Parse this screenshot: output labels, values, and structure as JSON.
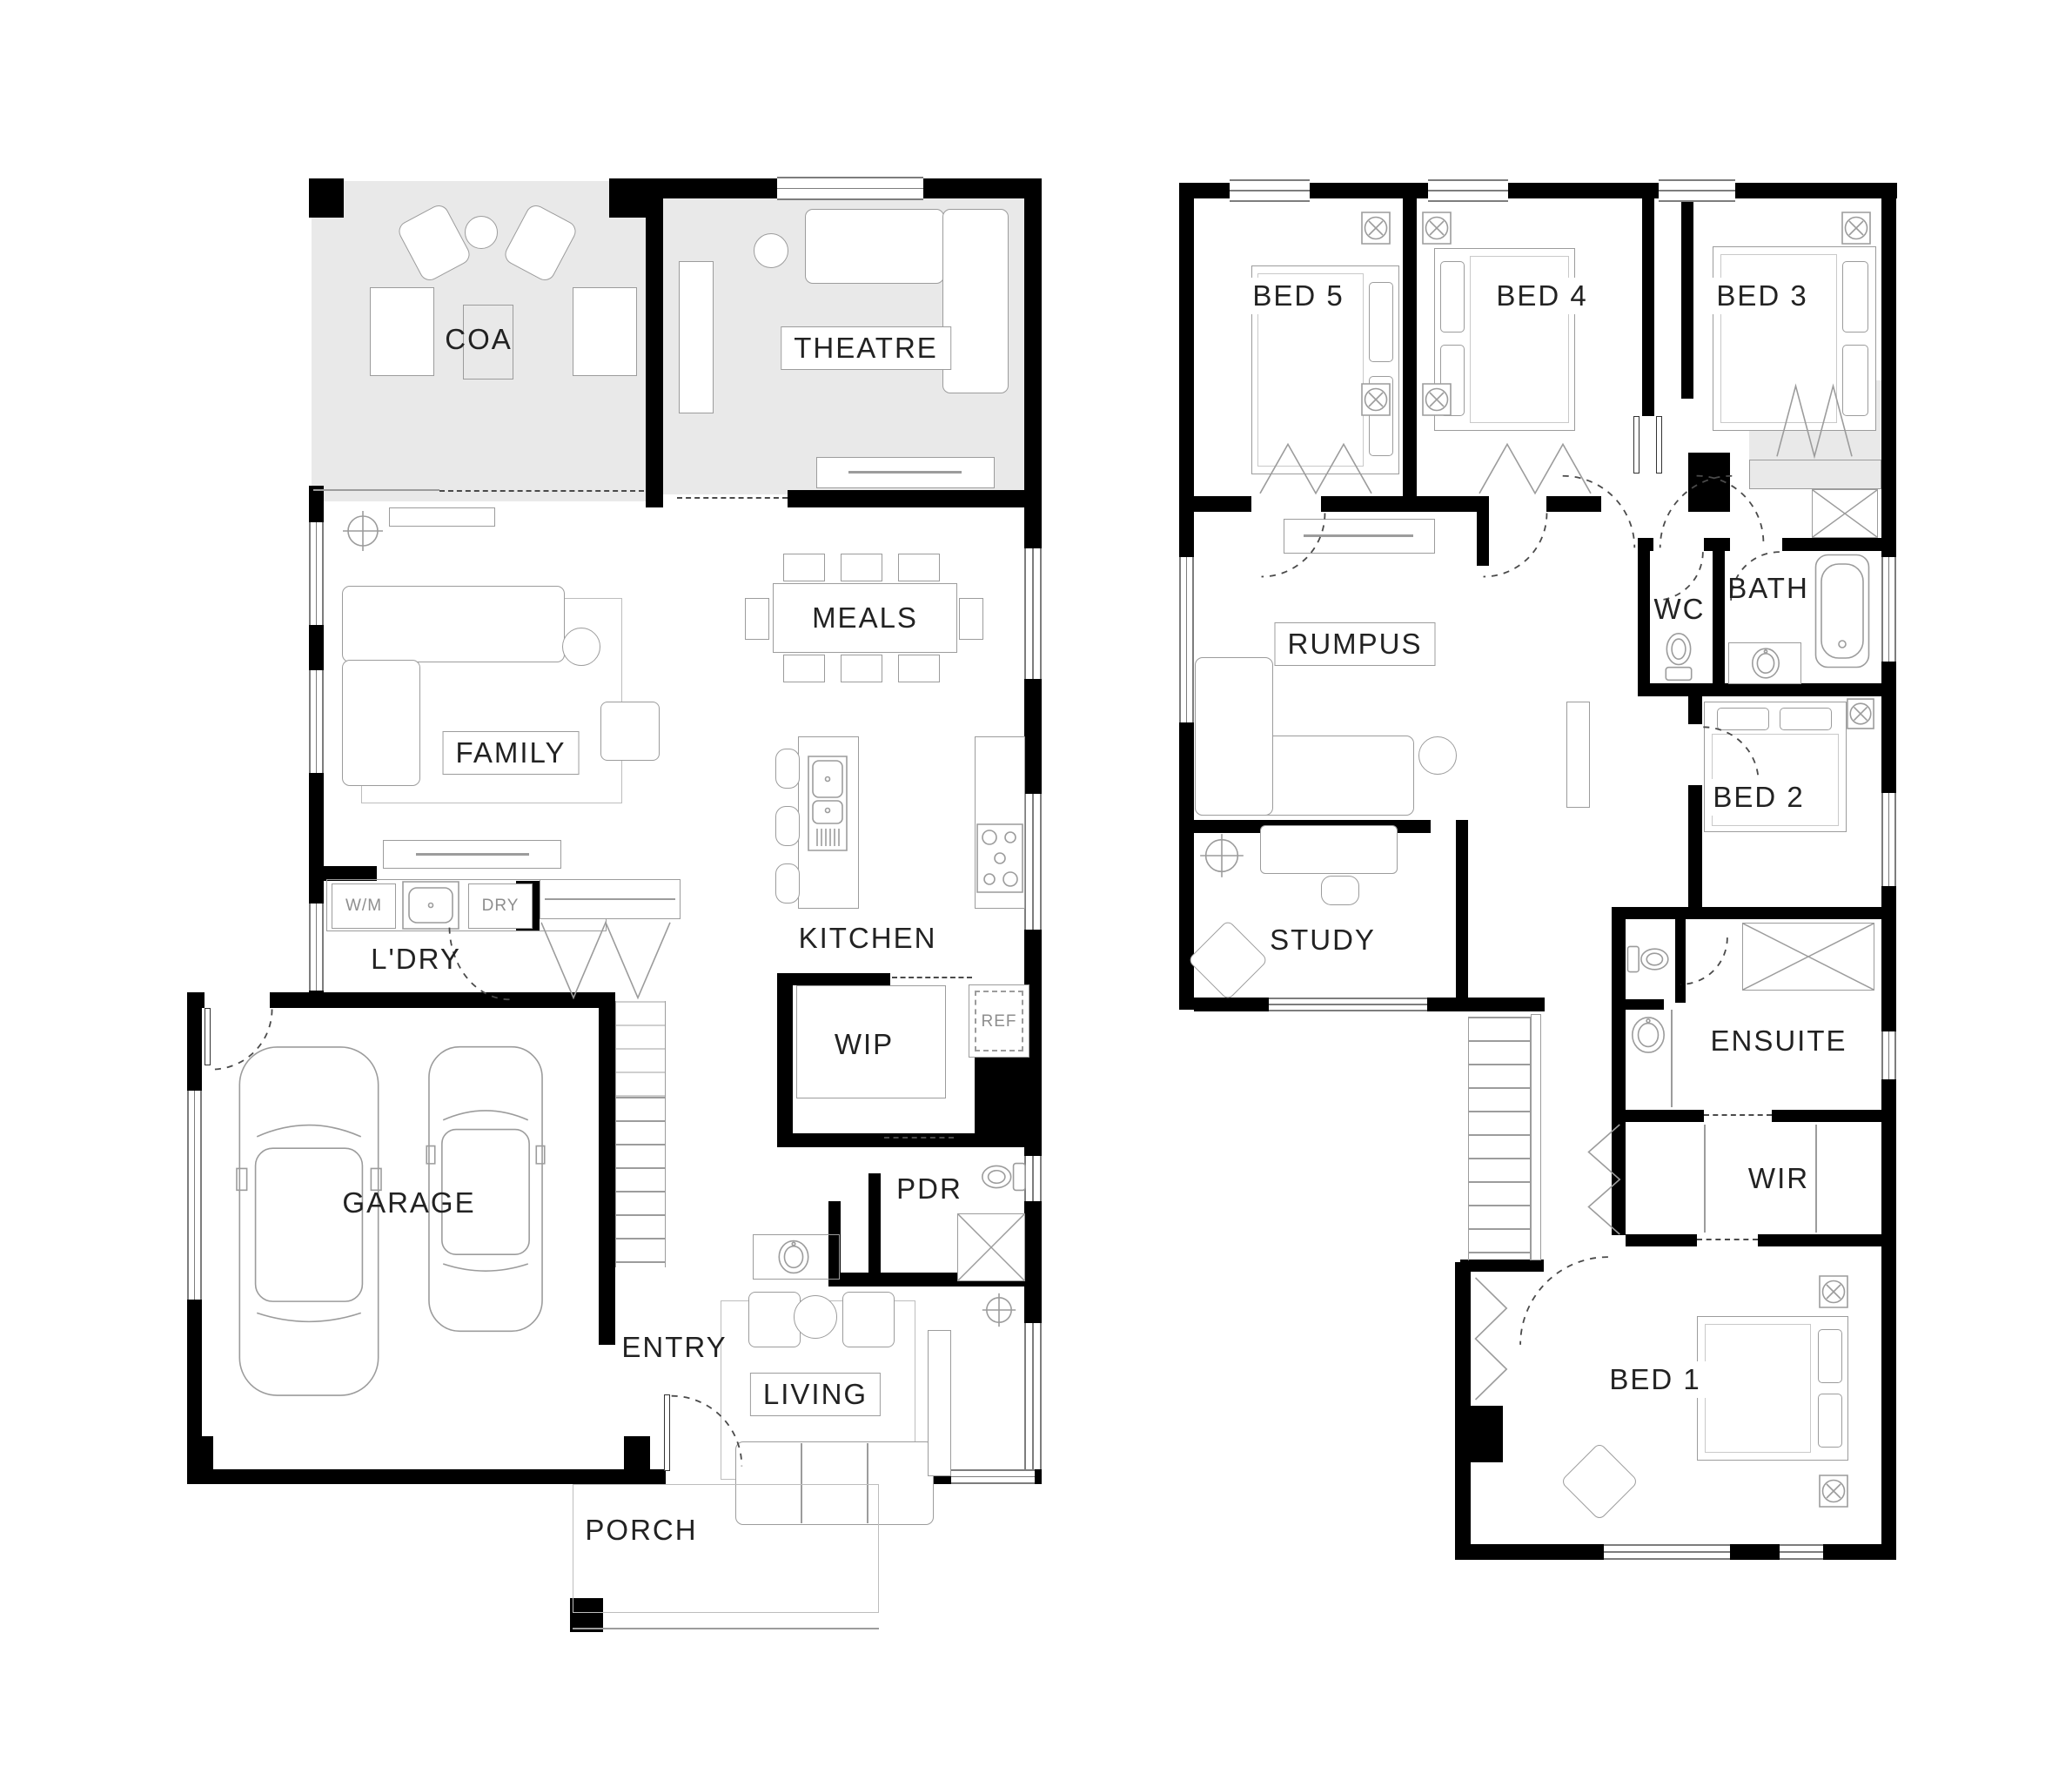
{
  "document": {
    "type": "architectural floor plan",
    "storeys": 2
  },
  "floors": {
    "ground": {
      "rooms": {
        "coa": "COA",
        "theatre": "THEATRE",
        "meals": "MEALS",
        "family": "FAMILY",
        "ldry": "L'DRY",
        "kitchen": "KITCHEN",
        "wip": "WIP",
        "garage": "GARAGE",
        "pdr": "PDR",
        "entry": "ENTRY",
        "living": "LIVING",
        "porch": "PORCH"
      },
      "appliances": {
        "wm": "W/M",
        "dry": "DRY",
        "ref": "REF"
      }
    },
    "first": {
      "rooms": {
        "bed5": "BED 5",
        "bed4": "BED 4",
        "bed3": "BED 3",
        "rumpus": "RUMPUS",
        "wc": "WC",
        "bath": "BATH",
        "bed2": "BED 2",
        "study": "STUDY",
        "ensuite": "ENSUITE",
        "wir": "WIR",
        "bed1": "BED 1"
      }
    }
  },
  "colors": {
    "wall": "#000000",
    "furniture_line": "#9c9c9c",
    "shaded_room_fill": "#e9e9e9",
    "label": "#222222",
    "label_muted": "#8e8e8e",
    "background": "#ffffff"
  }
}
